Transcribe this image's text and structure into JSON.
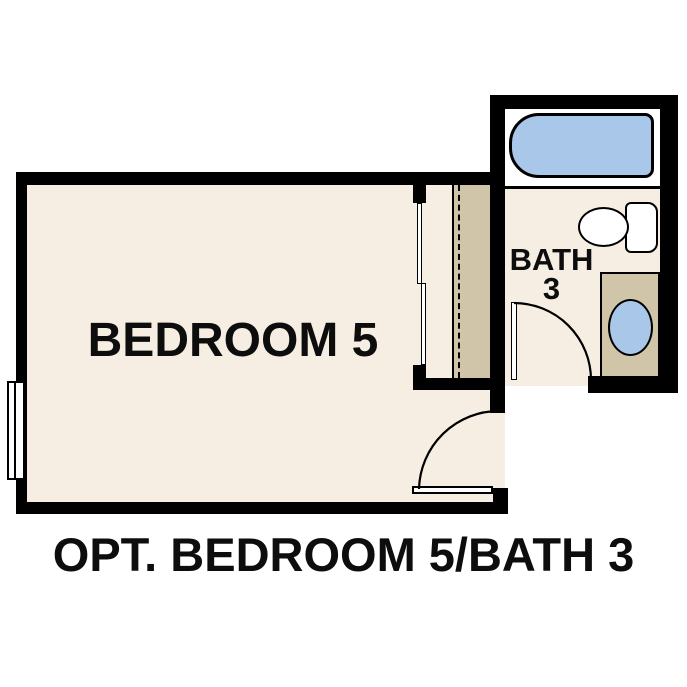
{
  "caption": "OPT. BEDROOM 5/BATH 3",
  "rooms": {
    "bedroom": {
      "name": "BEDROOM 5"
    },
    "bath": {
      "name_line1": "BATH",
      "name_line2": "3"
    }
  },
  "fixtures": {
    "bathtub": "bathtub",
    "toilet": "toilet",
    "sink": "vanity-sink",
    "vanity": "vanity-cabinet",
    "closet": "closet-bypass-doors-with-rod-and-shelf",
    "window": "window",
    "doors": [
      "bedroom-swing-door",
      "bath-swing-door"
    ]
  },
  "colors": {
    "wall": "#000000",
    "floor": "#f6eee2",
    "cabinet": "#d0c5a9",
    "fixture": "#a9c7e8",
    "background": "#ffffff",
    "text": "#0d0d0d"
  }
}
